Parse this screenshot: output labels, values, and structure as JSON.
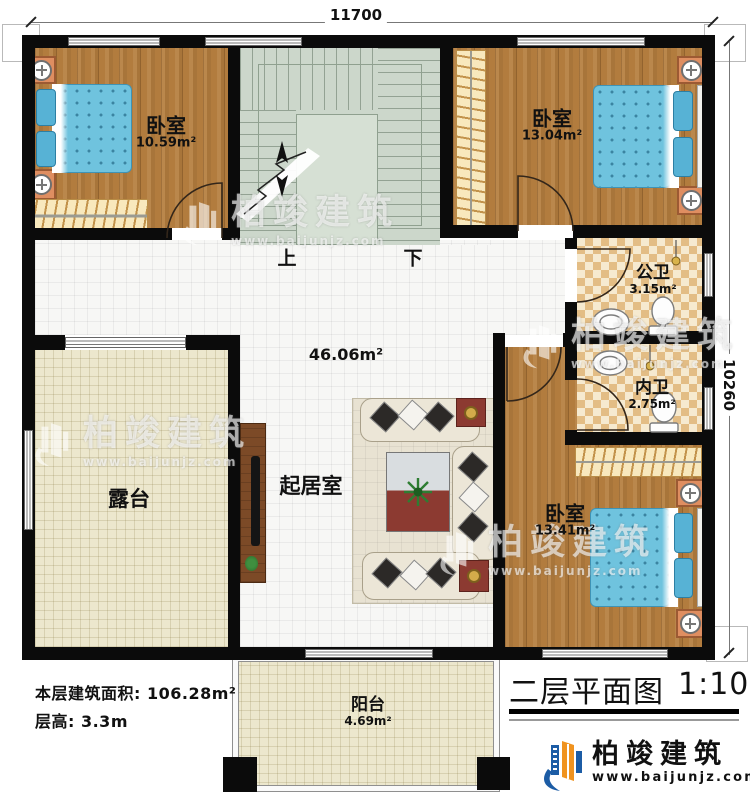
{
  "plan": {
    "dimensions": {
      "top": "11700",
      "right": "10260"
    },
    "rooms": {
      "bedroom_tl": {
        "name": "卧室",
        "area": "10.59m²"
      },
      "bedroom_tr": {
        "name": "卧室",
        "area": "13.04m²"
      },
      "bedroom_br": {
        "name": "卧室",
        "area": "13.41m²"
      },
      "bath_public": {
        "name": "公卫",
        "area": "3.15m²"
      },
      "bath_private": {
        "name": "内卫",
        "area": "2.75m²"
      },
      "living": {
        "name": "起居室",
        "area": "46.06m²"
      },
      "terrace": {
        "name": "露台"
      },
      "balcony": {
        "name": "阳台",
        "area": "4.69m²"
      }
    },
    "stairs": {
      "up": "上",
      "down": "下"
    }
  },
  "notes": {
    "floor_area": "本层建筑面积: 106.28m²",
    "floor_height": "层高: 3.3m"
  },
  "titleblock": {
    "title": "二层平面图",
    "scale": "1:100"
  },
  "brand": {
    "name": "柏竣建筑",
    "url": "www.baijunjz.com"
  },
  "colors": {
    "wall": "#0b0b0b",
    "wood": "#b27c3e",
    "tile": "#f7f7f5",
    "terrace": "#ece7cd",
    "stair": "#ccd7cb",
    "bath_dark": "#e3bd85",
    "bath_light": "#f6ead0",
    "bed_blue": "#6fc3de",
    "logo_blue": "#1c5ca5",
    "logo_orange": "#f0931f"
  }
}
